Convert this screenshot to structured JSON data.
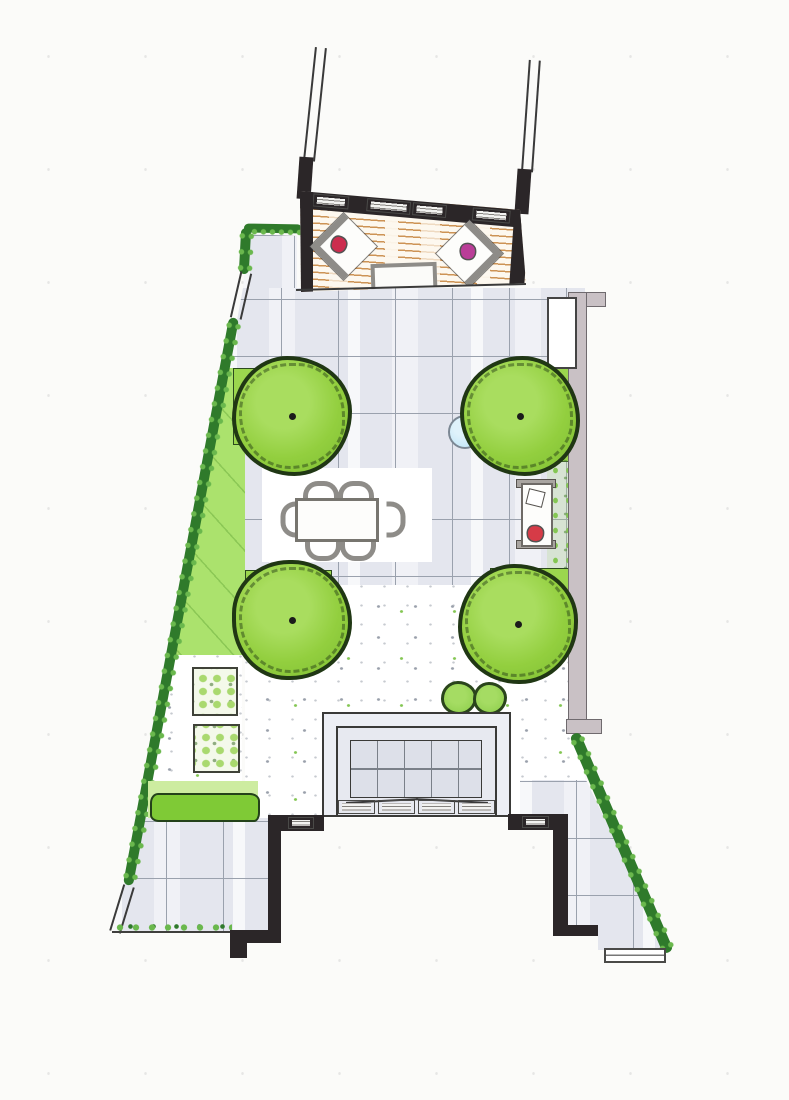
{
  "title": "Hand-drawn garden design plan, top view (marker rendering, no text labels)",
  "colors": {
    "paper": "#fbfbf9",
    "paving": "#e4e6ee",
    "grid_line": "#9aa1ad",
    "deck_bg": "#fdf8ef",
    "plank": "#cd9355",
    "wall_black": "#2b2628",
    "panel": "#f3f3f1",
    "tree_outline": "#203714",
    "tree_mid": "#93cf3f",
    "tree_light": "#a9dd5f",
    "tree_dark": "#7cbd31",
    "bed": "#9bd64e",
    "bed_outline": "#2c4a1e",
    "lawn": "#abe26d",
    "hedge": "#2f7a2b",
    "hedge_leaf": "#6ab84d",
    "lowhedge": "#7fca36",
    "lowhedge_bed": "#cdeca0",
    "planter_bg": "#f4f9ea",
    "planter_leaf": "#a9d96e",
    "wallstrip": "#c9c1c5",
    "wallstrip_border": "#6f6a6e",
    "water": "#b9e3f6",
    "water_border": "#7c8894",
    "cushion_red": "#cc2d4e",
    "cushion_magenta": "#ba3e98",
    "lounger_cushion": "#d63b47",
    "gray_frame": "#8e8c88",
    "gravel_dot": "#9aa0ab",
    "gravel_green": "#84c653"
  },
  "inventory": {
    "areas": [
      {
        "name": "timber-deck-terrace",
        "count": 1
      },
      {
        "name": "paved-tile-terrace",
        "count": 1
      },
      {
        "name": "white-dining-pad",
        "count": 1
      },
      {
        "name": "gravel-area",
        "count": 3
      },
      {
        "name": "lawn-strip",
        "count": 1
      },
      {
        "name": "side-passage-paving",
        "count": 2
      }
    ],
    "planting": [
      {
        "name": "specimen-tree",
        "count": 4
      },
      {
        "name": "planting-bed-square",
        "count": 4
      },
      {
        "name": "boundary-hedge",
        "count": 3
      },
      {
        "name": "low-clipped-hedge",
        "count": 1
      },
      {
        "name": "square-planter",
        "count": 2
      },
      {
        "name": "small-shrub",
        "count": 2
      },
      {
        "name": "green-gravel-border",
        "count": 1
      }
    ],
    "furniture": [
      {
        "name": "corner-lounge-chair",
        "count": 2
      },
      {
        "name": "chair-cushion-red",
        "count": 1
      },
      {
        "name": "chair-cushion-magenta",
        "count": 1
      },
      {
        "name": "deck-coffee-table",
        "count": 1
      },
      {
        "name": "dining-table",
        "count": 1
      },
      {
        "name": "dining-chair",
        "count": 6
      },
      {
        "name": "sun-lounger",
        "count": 1
      },
      {
        "name": "lounger-cushion",
        "count": 1
      },
      {
        "name": "water-bowl",
        "count": 1
      }
    ],
    "structures": [
      {
        "name": "neighbor-boundary-wall",
        "count": 2
      },
      {
        "name": "privacy-screen-panel",
        "count": 4
      },
      {
        "name": "garden-wall-right",
        "count": 1
      },
      {
        "name": "storage-unit",
        "count": 1
      },
      {
        "name": "garden-gate-double-line",
        "count": 2
      },
      {
        "name": "house-extension-bay",
        "count": 1
      },
      {
        "name": "glazed-roof-grid",
        "count": 1
      },
      {
        "name": "sliding-door-panel",
        "count": 4
      },
      {
        "name": "wing-window",
        "count": 2
      },
      {
        "name": "door-mat-step",
        "count": 1
      }
    ]
  }
}
